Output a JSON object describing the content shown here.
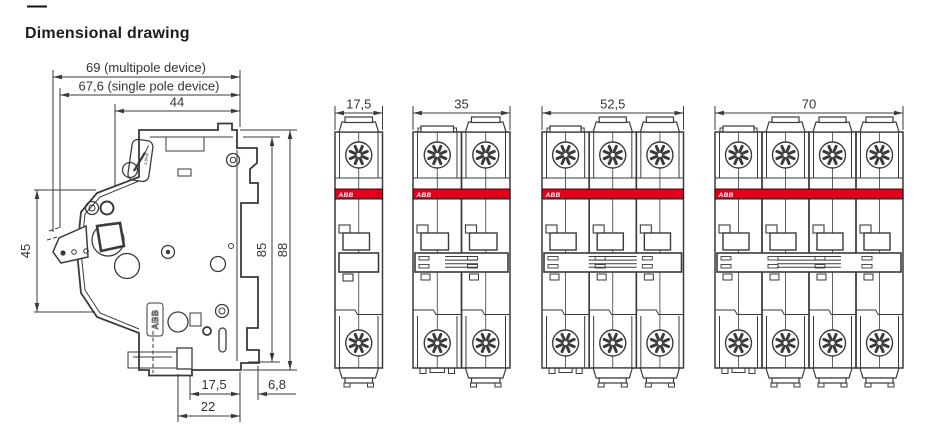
{
  "header": {
    "dash": "—",
    "title": "Dimensional drawing"
  },
  "colors": {
    "line": "#3a3a3a",
    "dim_text": "#333333",
    "abb_red": "#e2001a",
    "band_text": "#ffffff"
  },
  "side_view": {
    "dimensions": {
      "top": [
        {
          "label": "69 (multipole device)"
        },
        {
          "label": "67,6 (single pole device)"
        },
        {
          "label": "44"
        }
      ],
      "left": [
        {
          "label": "45"
        }
      ],
      "right": [
        {
          "label": "85"
        },
        {
          "label": "88"
        }
      ],
      "bottom": [
        {
          "label": "17,5"
        },
        {
          "label": "6,8"
        },
        {
          "label": "22"
        }
      ]
    },
    "markings": {
      "logo": "ABB",
      "torque": "2.8Nm"
    }
  },
  "front_views": [
    {
      "poles": 1,
      "width_label": "17,5",
      "brand": "ABB"
    },
    {
      "poles": 2,
      "width_label": "35",
      "brand": "ABB"
    },
    {
      "poles": 3,
      "width_label": "52,5",
      "brand": "ABB"
    },
    {
      "poles": 4,
      "width_label": "70",
      "brand": "ABB"
    }
  ]
}
